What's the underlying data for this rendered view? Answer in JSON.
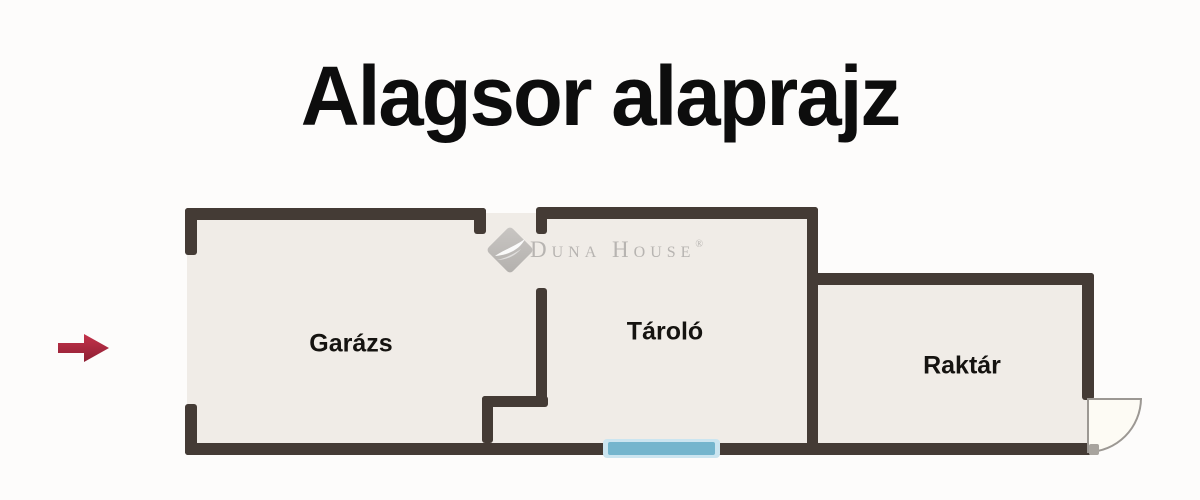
{
  "title": "Alagsor alaprajz",
  "watermark": {
    "brand": "Duna House",
    "registered": "®"
  },
  "plan": {
    "rooms": [
      {
        "id": "garazs",
        "label": "Garázs"
      },
      {
        "id": "tarolo",
        "label": "Tároló"
      },
      {
        "id": "raktar",
        "label": "Raktár"
      }
    ],
    "features": {
      "window": "window-marker",
      "door": "door-swing-quarter-circle",
      "entrance_arrow": "right-arrow"
    }
  },
  "icons": {
    "logo": "duna-house-diamond-icon",
    "arrow": "right-arrow-icon"
  },
  "colors": {
    "background": "#fdfcfb",
    "text": "#0d0d0d",
    "wall": "#443b35",
    "floor": "#f0ece7",
    "window": "#74b5cd",
    "window_halo": "#cbe5f0",
    "door_fill": "#fdfbf4",
    "door_stroke": "#9c9893",
    "threshold": "#a8a49e",
    "arrow_top": "#c4334b",
    "arrow_bottom": "#8e1f33",
    "logo_gray": "#c9c6c3",
    "logo_gray_dark": "#b3b0ad",
    "logo_text": "#b7b4b1"
  }
}
